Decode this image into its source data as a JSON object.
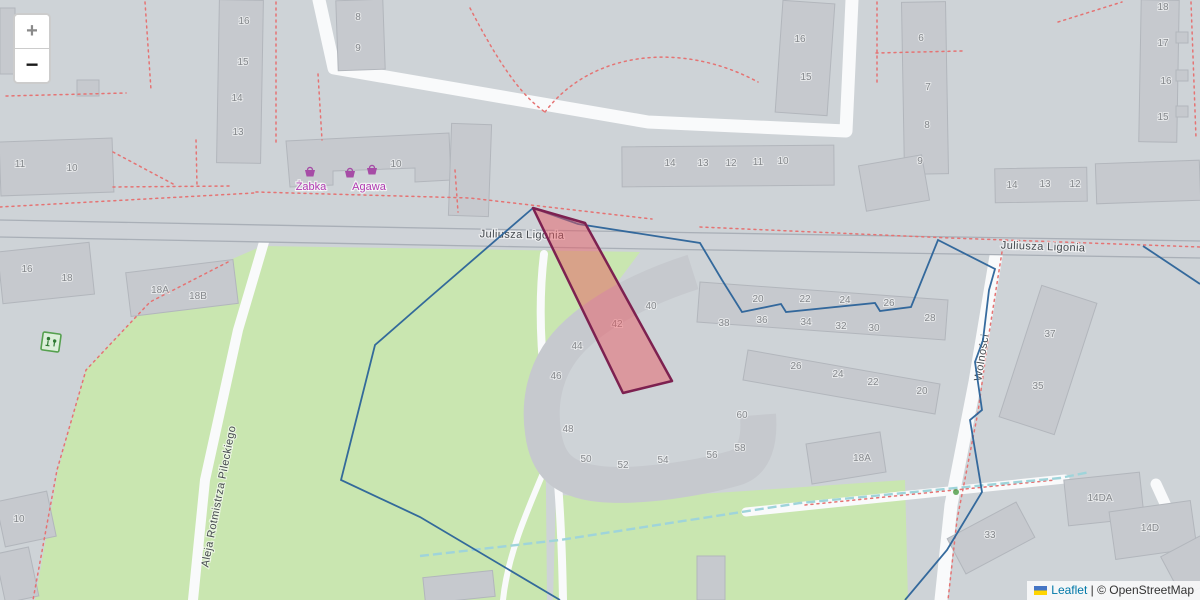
{
  "attribution": {
    "leaflet_label": "Leaflet",
    "separator": "|",
    "osm_label": "© OpenStreetMap"
  },
  "zoom_control": {
    "zoom_in_label": "+",
    "zoom_out_label": "−"
  },
  "streets": [
    {
      "t": "Juliusza Ligonia",
      "x": 522,
      "y": 238,
      "rot": 1
    },
    {
      "t": "Juliusza Ligonia",
      "x": 1043,
      "y": 250,
      "rot": 2
    },
    {
      "t": "Aleja Rotmistrza Pileckiego",
      "x": 222,
      "y": 497,
      "rot": -79
    },
    {
      "t": "Wolności",
      "x": 985,
      "y": 358,
      "rot": -81
    }
  ],
  "shops": {
    "labels": [
      {
        "t": "Żabka",
        "x": 311,
        "y": 190
      },
      {
        "t": "Agawa",
        "x": 369,
        "y": 190
      }
    ],
    "basket_positions": [
      {
        "x": 310,
        "y": 172
      },
      {
        "x": 350,
        "y": 173
      },
      {
        "x": 372,
        "y": 170
      }
    ]
  },
  "building_numbers": [
    {
      "t": "11",
      "x": 20,
      "y": 167
    },
    {
      "t": "10",
      "x": 72,
      "y": 171
    },
    {
      "t": "16",
      "x": 244,
      "y": 24
    },
    {
      "t": "15",
      "x": 243,
      "y": 65
    },
    {
      "t": "14",
      "x": 237,
      "y": 101
    },
    {
      "t": "13",
      "x": 238,
      "y": 135
    },
    {
      "t": "8",
      "x": 358,
      "y": 20
    },
    {
      "t": "9",
      "x": 358,
      "y": 51
    },
    {
      "t": "10",
      "x": 396,
      "y": 167
    },
    {
      "t": "14",
      "x": 670,
      "y": 166
    },
    {
      "t": "13",
      "x": 703,
      "y": 166
    },
    {
      "t": "12",
      "x": 731,
      "y": 166
    },
    {
      "t": "11",
      "x": 758,
      "y": 165
    },
    {
      "t": "10",
      "x": 783,
      "y": 164
    },
    {
      "t": "16",
      "x": 800,
      "y": 42
    },
    {
      "t": "15",
      "x": 806,
      "y": 80
    },
    {
      "t": "6",
      "x": 921,
      "y": 41
    },
    {
      "t": "7",
      "x": 928,
      "y": 90
    },
    {
      "t": "8",
      "x": 927,
      "y": 128
    },
    {
      "t": "9",
      "x": 920,
      "y": 164
    },
    {
      "t": "18",
      "x": 1163,
      "y": 10
    },
    {
      "t": "17",
      "x": 1163,
      "y": 46
    },
    {
      "t": "16",
      "x": 1166,
      "y": 84
    },
    {
      "t": "15",
      "x": 1163,
      "y": 120
    },
    {
      "t": "14",
      "x": 1012,
      "y": 188
    },
    {
      "t": "13",
      "x": 1045,
      "y": 187
    },
    {
      "t": "12",
      "x": 1075,
      "y": 187
    },
    {
      "t": "20",
      "x": 758,
      "y": 302
    },
    {
      "t": "22",
      "x": 805,
      "y": 302
    },
    {
      "t": "24",
      "x": 845,
      "y": 303
    },
    {
      "t": "26",
      "x": 889,
      "y": 306
    },
    {
      "t": "38",
      "x": 724,
      "y": 326
    },
    {
      "t": "36",
      "x": 762,
      "y": 323
    },
    {
      "t": "34",
      "x": 806,
      "y": 325
    },
    {
      "t": "32",
      "x": 841,
      "y": 329
    },
    {
      "t": "30",
      "x": 874,
      "y": 331
    },
    {
      "t": "28",
      "x": 930,
      "y": 321
    },
    {
      "t": "40",
      "x": 651,
      "y": 309
    },
    {
      "t": "42",
      "x": 617,
      "y": 327
    },
    {
      "t": "44",
      "x": 577,
      "y": 349
    },
    {
      "t": "46",
      "x": 556,
      "y": 379
    },
    {
      "t": "48",
      "x": 568,
      "y": 432
    },
    {
      "t": "50",
      "x": 586,
      "y": 462
    },
    {
      "t": "52",
      "x": 623,
      "y": 468
    },
    {
      "t": "54",
      "x": 663,
      "y": 463
    },
    {
      "t": "56",
      "x": 712,
      "y": 458
    },
    {
      "t": "58",
      "x": 740,
      "y": 451
    },
    {
      "t": "60",
      "x": 742,
      "y": 418
    },
    {
      "t": "26",
      "x": 796,
      "y": 369
    },
    {
      "t": "24",
      "x": 838,
      "y": 377
    },
    {
      "t": "22",
      "x": 873,
      "y": 385
    },
    {
      "t": "20",
      "x": 922,
      "y": 394
    },
    {
      "t": "18A",
      "x": 862,
      "y": 461
    },
    {
      "t": "37",
      "x": 1050,
      "y": 337
    },
    {
      "t": "35",
      "x": 1038,
      "y": 389
    },
    {
      "t": "16",
      "x": 27,
      "y": 272
    },
    {
      "t": "18",
      "x": 67,
      "y": 281
    },
    {
      "t": "18A",
      "x": 160,
      "y": 293
    },
    {
      "t": "18B",
      "x": 198,
      "y": 299
    },
    {
      "t": "10",
      "x": 19,
      "y": 522
    },
    {
      "t": "14DA",
      "x": 1100,
      "y": 501
    },
    {
      "t": "14D",
      "x": 1150,
      "y": 531
    },
    {
      "t": "33",
      "x": 990,
      "y": 538
    }
  ],
  "colors": {
    "map-bg": "#ced3d7",
    "park": "#c9e6b0",
    "building": "#c6c9ce",
    "road": "#f9fafb",
    "path-dash": "#e57373",
    "boundary": "#2b6399",
    "highlight-stroke": "#7d2150",
    "shop": "#b23bb2",
    "link": "#0078a8"
  }
}
